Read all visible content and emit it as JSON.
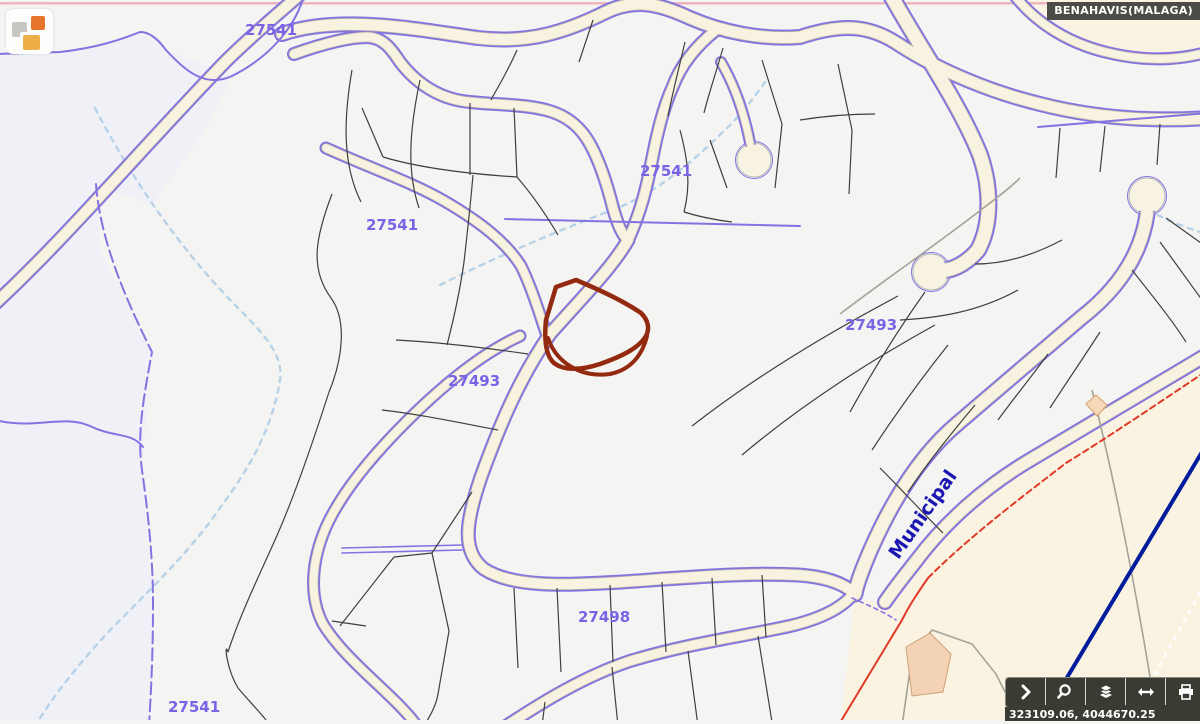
{
  "header": {
    "municipality_badge": "BENAHAVIS(MALAGA)"
  },
  "logo": {
    "name": "catastro-logo",
    "square_colors": {
      "gray": "#c9c7c4",
      "orange": "#e8752c",
      "amber": "#efae47"
    }
  },
  "map": {
    "parcel_labels": [
      {
        "text": "27541"
      },
      {
        "text": "27541"
      },
      {
        "text": "27541"
      },
      {
        "text": "27493"
      },
      {
        "text": "27493"
      },
      {
        "text": "27498"
      },
      {
        "text": "27541"
      }
    ],
    "municipal_boundary_label": "Municipal",
    "selected_parcel_color": "#93290f",
    "colors": {
      "background": "#f4f4f2",
      "road_fill": "#f8f3e1",
      "road_casing": "#b9b6a9",
      "cadastral_purple": "#8572e2",
      "parcel_line": "#3f3f3f",
      "stream_blue": "#b7d2e8",
      "boundary_red": "#e03a26",
      "navy_line": "#001c9c",
      "beige_zone": "#faf3e2",
      "tint_zone": "#edf0f8",
      "label_purple": "#7b63e6",
      "municipal_blue": "#1c16b2"
    }
  },
  "toolbar": {
    "buttons": [
      {
        "name": "expand-toolbar",
        "icon": "chevron-right-icon"
      },
      {
        "name": "zoom-search",
        "icon": "magnifier-icon"
      },
      {
        "name": "layers",
        "icon": "layers-icon"
      },
      {
        "name": "measure-pan",
        "icon": "horizontal-arrows-icon"
      },
      {
        "name": "print",
        "icon": "printer-icon"
      }
    ]
  },
  "statusbar": {
    "coordinates": "323109.06, 4044670.25"
  }
}
